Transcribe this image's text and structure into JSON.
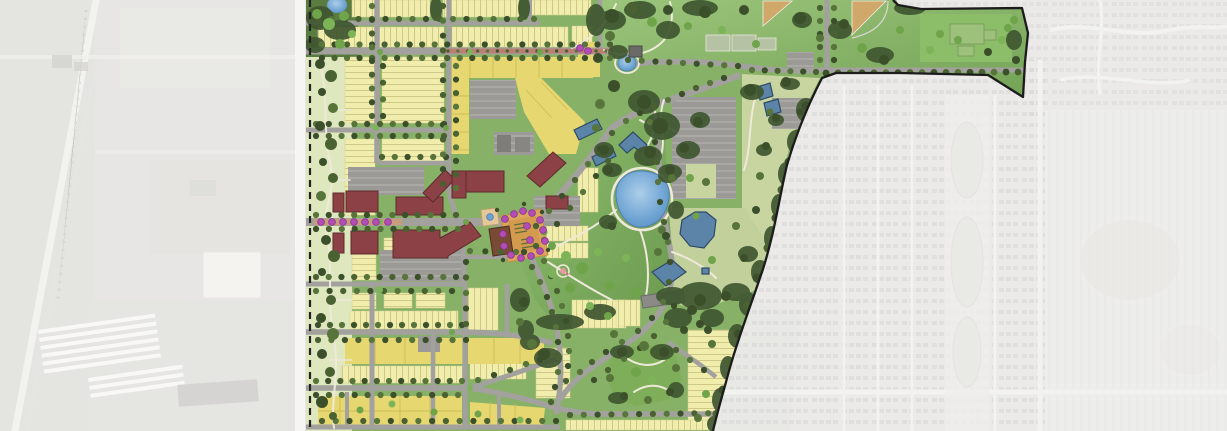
{
  "image": {
    "kind": "master-plan-site-rendering",
    "description": "colored neighborhood master plan over grayscale aerial photo"
  },
  "palette": {
    "aerial_base": "#d8d7d4",
    "aerial_road": "#eceae5",
    "aerial_structure": "#c0bfba",
    "aerial_white": "#f3f2ee",
    "plan_green": "#86b166",
    "lawn_light": "#9cc57c",
    "lawn_dark": "#6b9a4f",
    "tree_olive": "#4a6132",
    "tree_dark": "#3a4f2a",
    "tree_bright": "#6fa44b",
    "greenway": "#dfe7bf",
    "lot_pale": "#f1edad",
    "lot_line": "#cfc887",
    "lot_deep": "#e7d771",
    "lot_deep_line": "#cdbd58",
    "sage": "#c8d5a0",
    "road": "#a2a19e",
    "path": "#eee9d9",
    "parking": "#9b9a97",
    "stall": "#c6c5c2",
    "maroon": "#8b4145",
    "maroon_outline": "#5f2b2e",
    "brown": "#7a4b34",
    "blue": "#5c84a8",
    "blue_outline": "#2e4a66",
    "pond": "#6ca2d2",
    "pond_light": "#adceea",
    "plaza": "#dca75c",
    "plaza_dark": "#c58f49",
    "median_red": "#b97f72",
    "median_tan": "#c79e7c",
    "magenta": "#b34db6",
    "magenta_outline": "#8a3190",
    "boundary": "#1c1c1c",
    "court": "#b6c2a4",
    "infield": "#cfa86a",
    "suburb_house": "#b9b8b5",
    "farm": "#e1e0dc",
    "accent_pink": "#e898a3"
  },
  "features": {
    "context_west": {
      "label": "grayscale aerial context west - industrial land"
    },
    "context_east": {
      "label": "grayscale aerial context east - suburban subdivision and farmland"
    },
    "plan_area": {
      "label": "master plan development area"
    },
    "boundary": {
      "label": "plan boundary line"
    },
    "greenway_west": {
      "label": "western edge greenway"
    },
    "residential_blocks": {
      "label": "single-family and townhome lot blocks"
    },
    "medium_density": {
      "label": "medium density residential parcels"
    },
    "mixed_use": {
      "label": "main street mixed-use buildings"
    },
    "civic": {
      "label": "civic buildings"
    },
    "plaza": {
      "label": "town square plaza with flowering trees"
    },
    "fountain": {
      "label": "plaza fountain"
    },
    "central_park": {
      "label": "central park"
    },
    "pond": {
      "label": "pond"
    },
    "small_pond": {
      "label": "small round pond"
    },
    "sports_park": {
      "label": "community sports park"
    },
    "ball_diamond": {
      "label": "ball diamond"
    },
    "courts": {
      "label": "sport courts"
    },
    "school_site": {
      "label": "school site"
    },
    "parking": {
      "label": "surface parking lot"
    },
    "boulevard": {
      "label": "landscaped entry boulevard"
    },
    "se_park": {
      "label": "neighborhood park"
    },
    "stream": {
      "label": "stream corridor"
    },
    "trees": {
      "label": "tree canopy"
    }
  }
}
